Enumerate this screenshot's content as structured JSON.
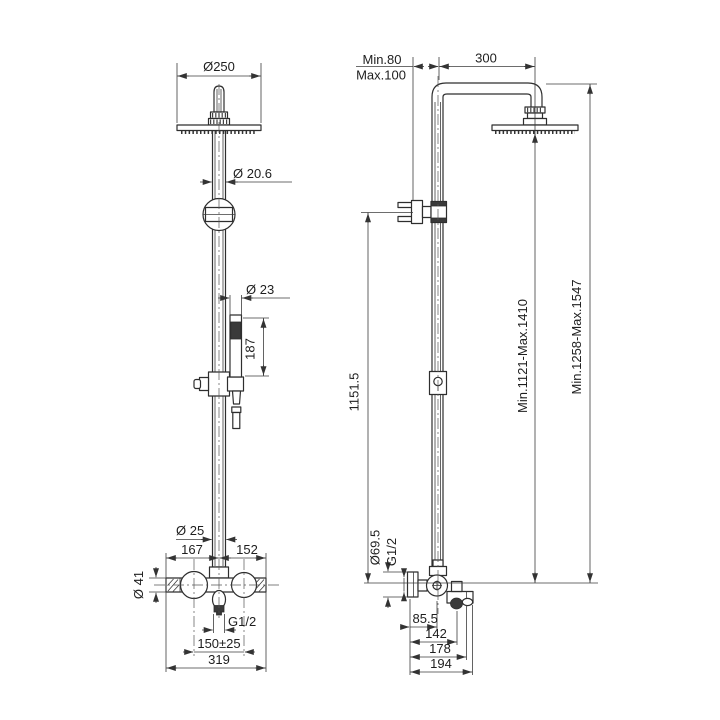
{
  "colors": {
    "background": "#ffffff",
    "line": "#2e2e2e",
    "dimension": "#3c3c3c",
    "text": "#1e1e1e"
  },
  "front_view": {
    "head_diameter": "Ø250",
    "upper_pipe_diameter": "Ø 20.6",
    "handshower_diameter": "Ø 23",
    "handshower_length": "187",
    "riser_diameter": "Ø 25",
    "left_offset": "167",
    "right_offset": "152",
    "body_diameter": "Ø 41",
    "outlet_thread": "G1/2",
    "supply_spacing": "150±25",
    "overall_width": "319"
  },
  "side_view": {
    "wall_clearance_min": "Min.80",
    "wall_clearance_max": "Max.100",
    "arm_projection": "300",
    "bracket_height": "1151.5",
    "head_height_range": "Min.1121-Max.1410",
    "overall_height_range": "Min.1258-Max.1547",
    "flange_diameter": "Ø69.5",
    "inlet_thread": "G1/2",
    "spout_offset": "85.5",
    "knob_depth": "142",
    "spout_depth": "178",
    "overall_depth": "194"
  }
}
